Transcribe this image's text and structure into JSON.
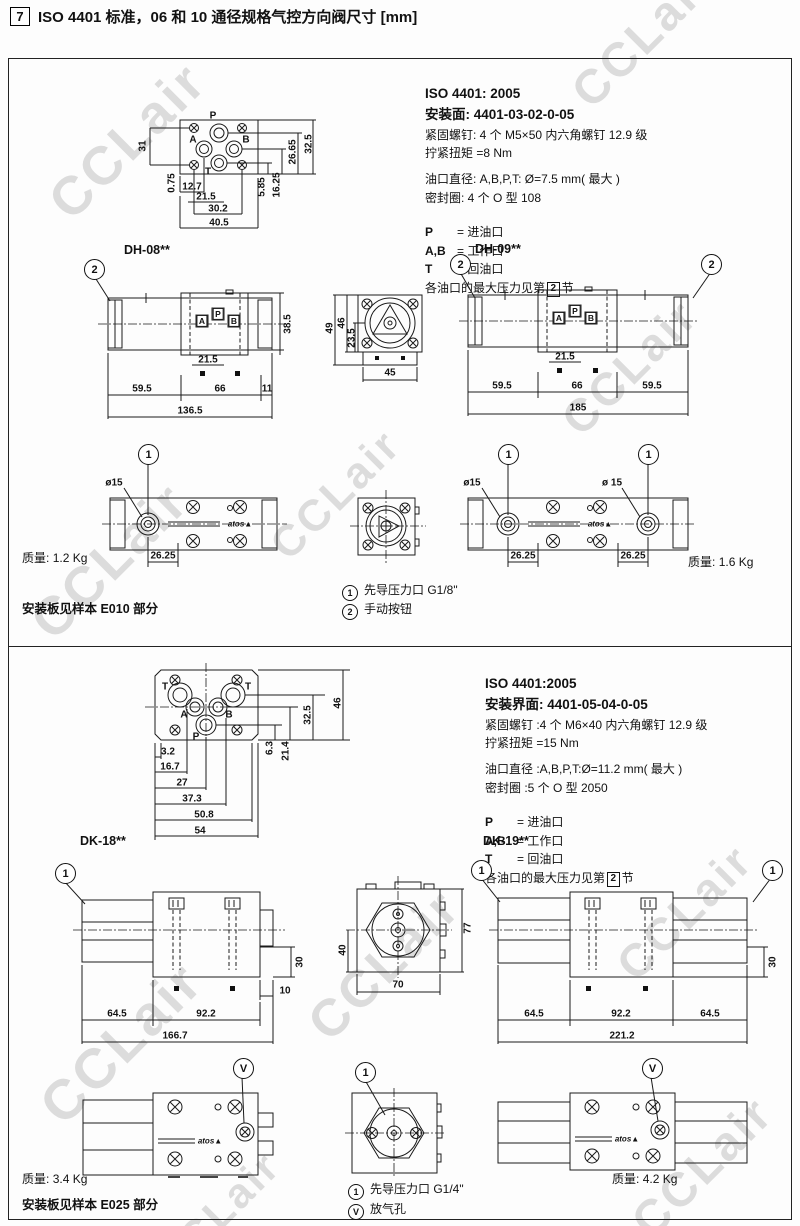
{
  "page": {
    "section_badge": "7",
    "title": "ISO 4401 标准，06 和 10 通径规格气控方向阀尺寸 [mm]",
    "watermark": "CCLair"
  },
  "dh": {
    "spec": {
      "standard": "ISO 4401: 2005",
      "surface": "安装面: 4401-03-02-0-05",
      "screws": "紧固螺钉: 4 个 M5×50 内六角螺钉 12.9 级",
      "torque": "拧紧扭矩 =8 Nm",
      "port_dia": "油口直径: A,B,P,T: Ø=7.5 mm( 最大 )",
      "seal": "密封圈: 4 个 O 型 108",
      "port_p": "P",
      "port_p_desc": "= 进油口",
      "port_ab": "A,B",
      "port_ab_desc": "= 工作口",
      "port_t": "T",
      "port_t_desc": "= 回油口",
      "pressure_pre": "各油口的最大压力见第",
      "pressure_ref": "2",
      "pressure_post": "节"
    },
    "face": {
      "ports": {
        "p": "P",
        "a": "A",
        "b": "B",
        "t": "T"
      },
      "dims": {
        "d31": "31",
        "d075": "0.75",
        "d127": "12.7",
        "d215": "21.5",
        "d302": "30.2",
        "d405": "40.5",
        "d585": "5.85",
        "d1625": "16.25",
        "d2665": "26.65",
        "d325": "32.5"
      }
    },
    "dh08": {
      "label": "DH-08**",
      "callout": "2",
      "ports": {
        "a": "A",
        "p": "P",
        "b": "B"
      },
      "dims": {
        "h": "38.5",
        "a": "21.5",
        "l1": "59.5",
        "l2": "66",
        "l3": "11",
        "total": "136.5"
      }
    },
    "end_top": {
      "dims": {
        "h1": "49",
        "h2": "46",
        "h3": "23.5",
        "w": "45"
      }
    },
    "dh09": {
      "label": "DH-09**",
      "callout_l": "2",
      "callout_r": "2",
      "ports": {
        "a": "A",
        "p": "P",
        "b": "B"
      },
      "dims": {
        "a": "21.5",
        "l1": "59.5",
        "l2": "66",
        "l3": "59.5",
        "total": "185"
      }
    },
    "dh08_bottom": {
      "callout": "1",
      "dia": "ø15",
      "dim": "26.25",
      "logo": "atos▲",
      "mass_label": "质量:",
      "mass": "1.2 Kg"
    },
    "dh09_bottom": {
      "callout_l": "1",
      "callout_r": "1",
      "dia_l": "ø15",
      "dia_r": "ø 15",
      "dim_l": "26.25",
      "dim_r": "26.25",
      "logo": "atos▲",
      "mass_label": "质量:",
      "mass": "1.6 Kg"
    },
    "board_note": "安装板见样本 E010 部分",
    "note1_num": "1",
    "note1": "先导压力口 G1/8\"",
    "note2_num": "2",
    "note2": "手动按钮"
  },
  "dk": {
    "spec": {
      "standard": "ISO 4401:2005",
      "surface": "安装界面: 4401-05-04-0-05",
      "screws": "紧固螺钉 :4 个 M6×40 内六角螺钉 12.9 级",
      "torque": "拧紧扭矩 =15 Nm",
      "port_dia": "油口直径 :A,B,P,T:Ø=11.2 mm( 最大 )",
      "seal": "密封圈 :5 个 O 型 2050",
      "port_p": "P",
      "port_p_desc": "= 进油口",
      "port_ab": "A,B",
      "port_ab_desc": "= 工作口",
      "port_t": "T",
      "port_t_desc": "= 回油口",
      "pressure_pre": "各油口的最大压力见第",
      "pressure_ref": "2",
      "pressure_post": "节"
    },
    "face": {
      "ports": {
        "t1": "T",
        "t2": "T",
        "a": "A",
        "b": "B",
        "p": "P"
      },
      "dims": {
        "d32": "3.2",
        "d167": "16.7",
        "d27": "27",
        "d373": "37.3",
        "d508": "50.8",
        "d54": "54",
        "d63": "6.3",
        "d214": "21.4",
        "d325": "32.5",
        "d46": "46"
      }
    },
    "dk18": {
      "label": "DK-18**",
      "callout": "1",
      "dims": {
        "d30": "30",
        "d10": "10",
        "l1": "64.5",
        "l2": "92.2",
        "total": "166.7"
      }
    },
    "end_top": {
      "dims": {
        "d40": "40",
        "d77": "77",
        "d70": "70"
      }
    },
    "dk19": {
      "label": "DK-19**",
      "callout_l": "1",
      "callout_r": "1",
      "dims": {
        "d30": "30",
        "l1": "64.5",
        "l2": "92.2",
        "l3": "64.5",
        "total": "221.2"
      }
    },
    "dk18_bottom": {
      "callout": "V",
      "logo": "atos▲",
      "mass_label": "质量:",
      "mass": "3.4 Kg"
    },
    "end_bottom": {
      "callout": "1"
    },
    "dk19_bottom": {
      "callout": "V",
      "logo": "atos▲",
      "mass_label": "质量:",
      "mass": "4.2 Kg"
    },
    "board_note": "安装板见样本 E025 部分",
    "note1_num": "1",
    "note1": "先导压力口 G1/4\"",
    "note2_num": "V",
    "note2": "放气孔"
  }
}
